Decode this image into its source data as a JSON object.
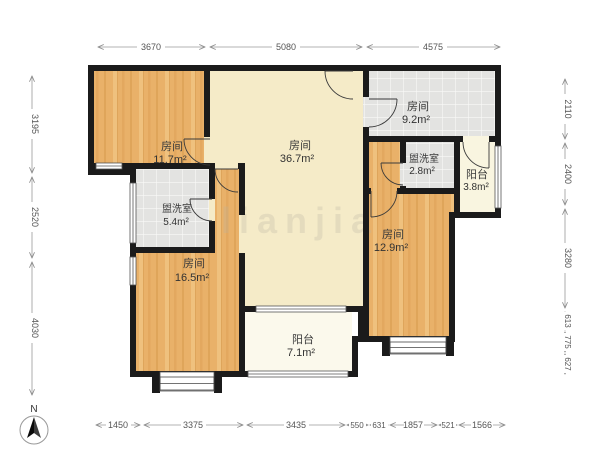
{
  "plan": {
    "rooms": [
      {
        "name": "房间",
        "area": "11.7m²"
      },
      {
        "name": "房间",
        "area": "36.7m²"
      },
      {
        "name": "房间",
        "area": "9.2m²"
      },
      {
        "name": "盥洗室",
        "area": "2.8m²"
      },
      {
        "name": "阳台",
        "area": "3.8m²"
      },
      {
        "name": "盥洗室",
        "area": "5.4m²"
      },
      {
        "name": "房间",
        "area": "16.5m²"
      },
      {
        "name": "房间",
        "area": "12.9m²"
      },
      {
        "name": "阳台",
        "area": "7.1m²"
      }
    ],
    "compass_label": "N",
    "watermark": "lianjia"
  },
  "dimensions": {
    "top": [
      "3670",
      "5080",
      "4575"
    ],
    "bottom": [
      "1450",
      "3375",
      "3435",
      "550",
      "631",
      "1857",
      "521",
      "1566"
    ],
    "left": [
      "3195",
      "2520",
      "4030"
    ],
    "right": [
      "2110",
      "2400",
      "3280",
      "613",
      "775",
      "627"
    ]
  },
  "colors": {
    "wall": "#1b1b1b",
    "wood_floor": "#e9b169",
    "cream_floor": "#f5ebc8",
    "tile_floor": "#e3e3e1",
    "balcony_floor": "#faf7e8"
  }
}
